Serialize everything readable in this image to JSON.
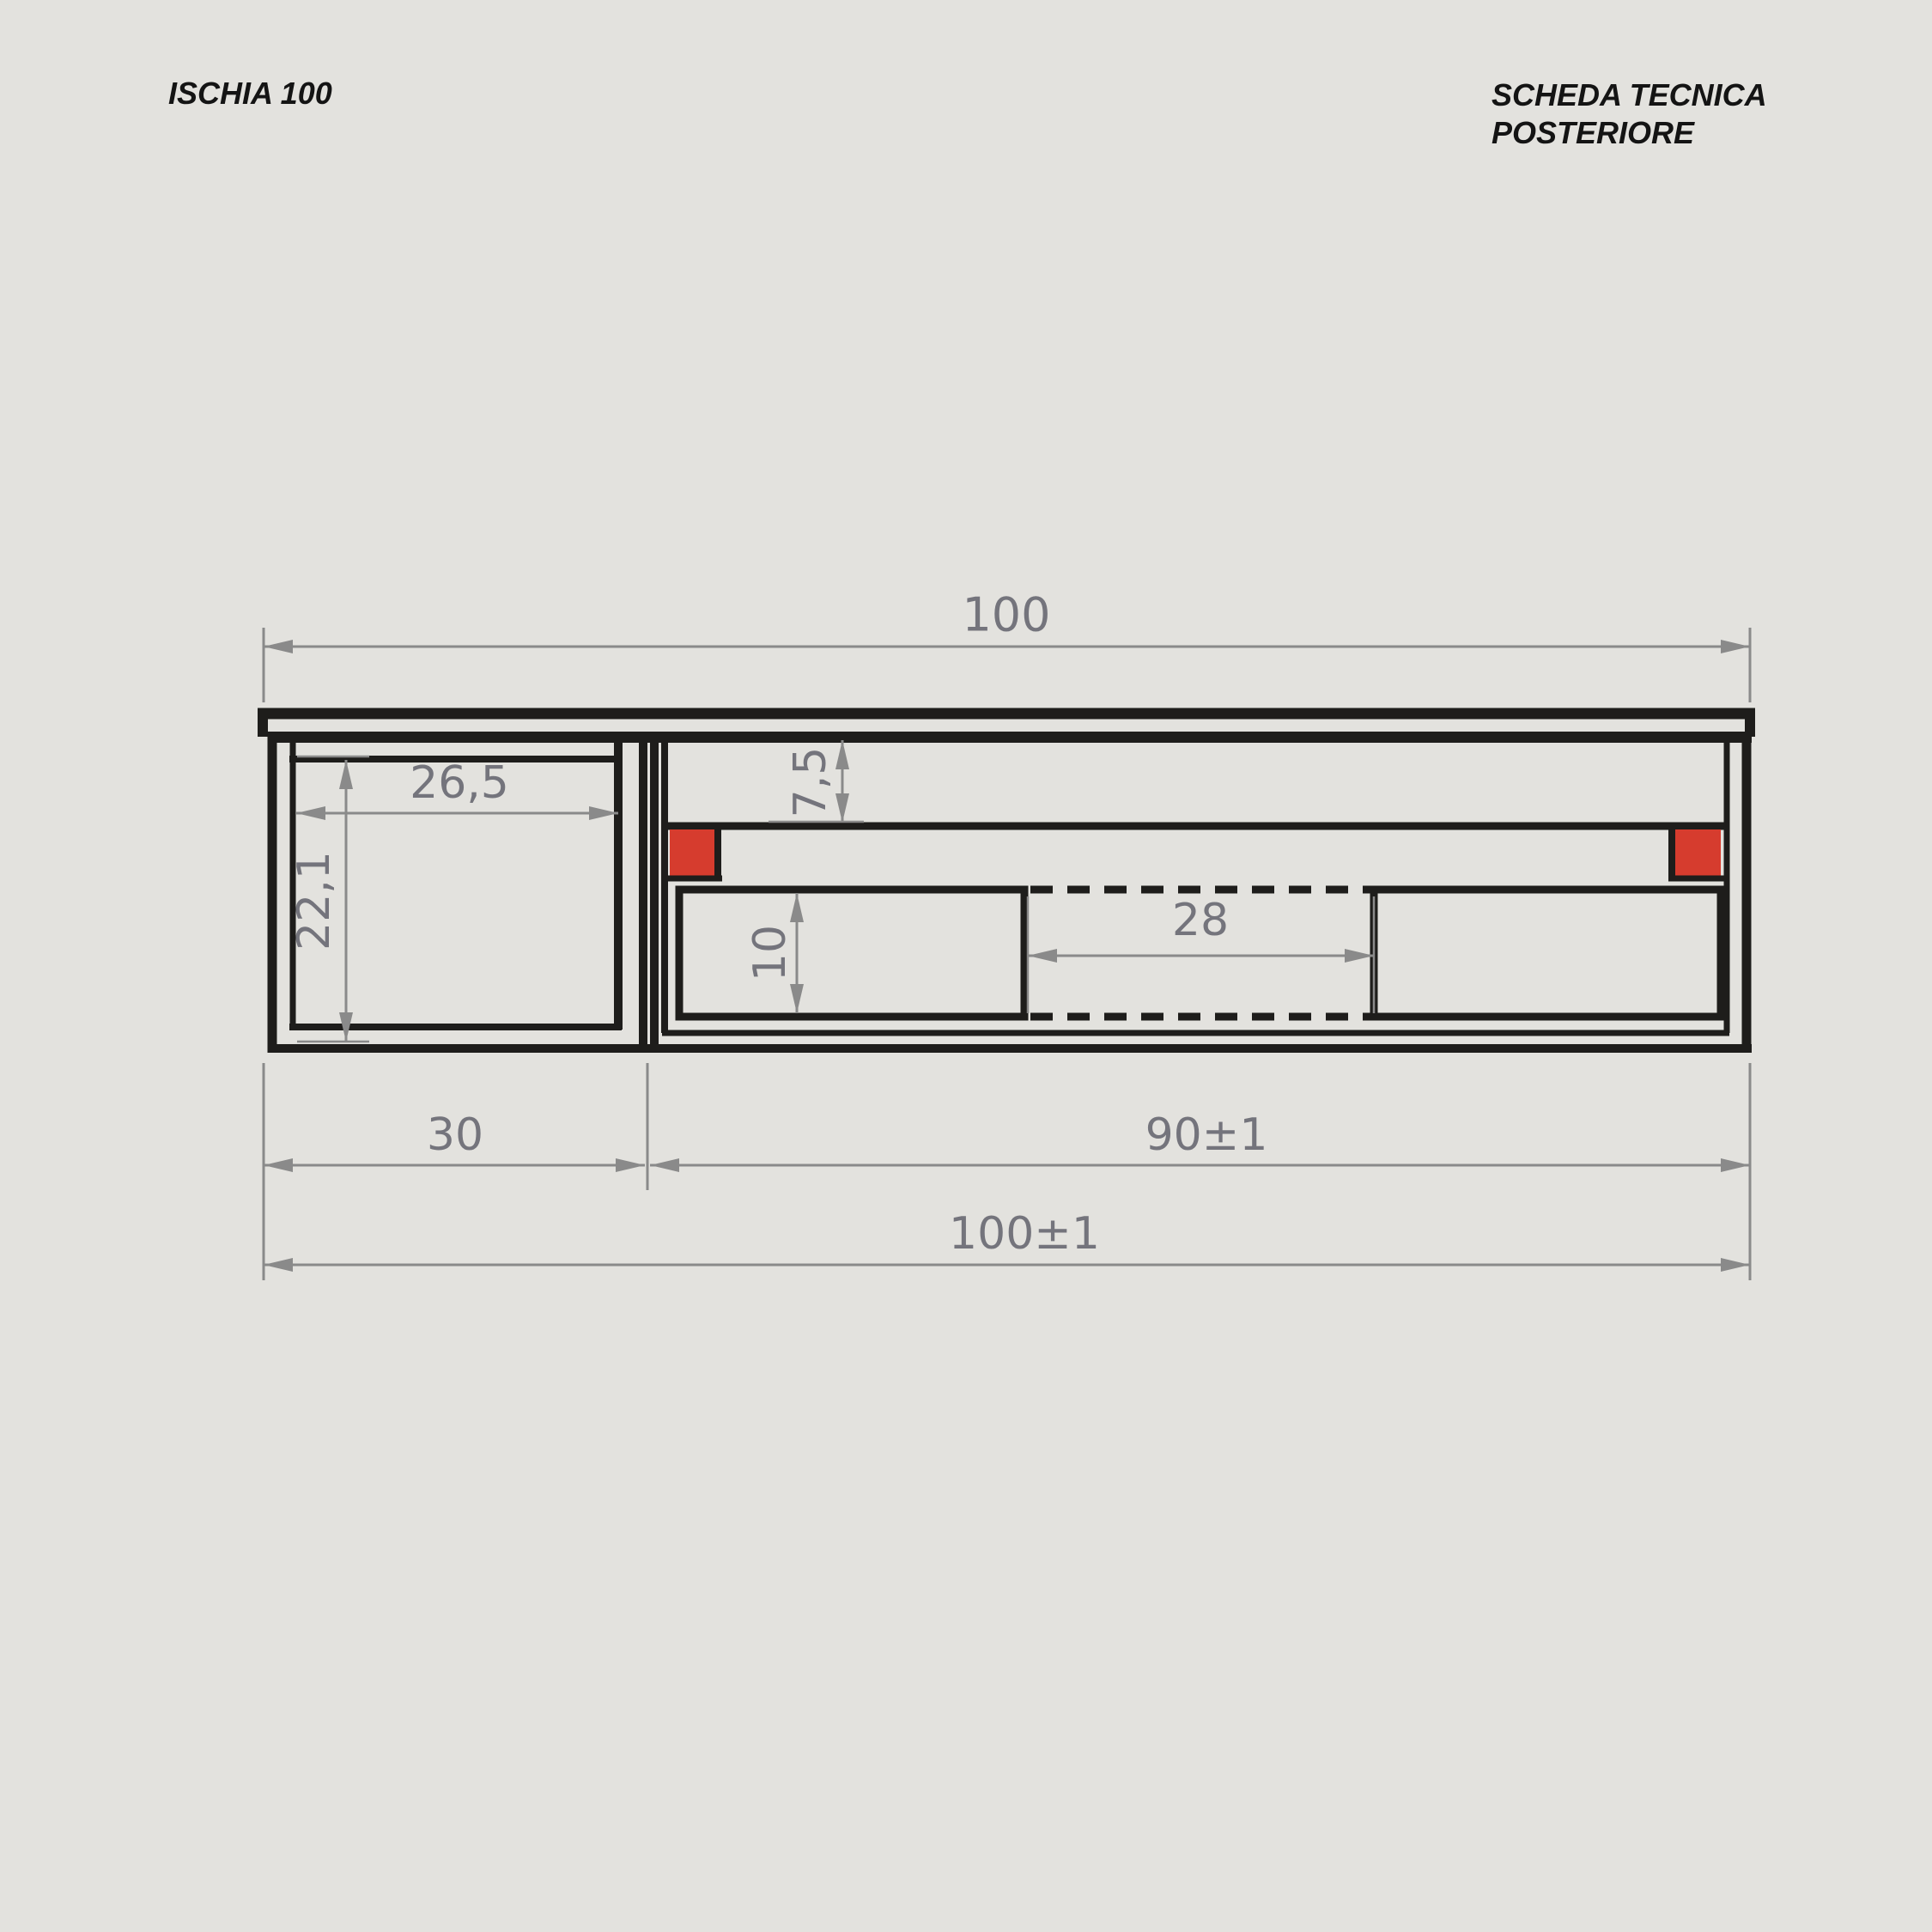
{
  "colors": {
    "background": "#e3e2de",
    "line": "#1e1d1b",
    "dimension_line": "#8a8a8a",
    "dimension_text": "#74747c",
    "accent_red": "#d63c2e",
    "title_text": "#141414"
  },
  "header": {
    "model": "ISCHIA 100",
    "sheet_title": "SCHEDA TECNICA",
    "sheet_subtitle": "POSTERIORE"
  },
  "drawing": {
    "type": "technical-drawing",
    "view": "rear",
    "dimensions": {
      "overall_width_top": "100",
      "left_compartment_width": "26,5",
      "left_compartment_height": "22,1",
      "rail_offset_from_top": "7,5",
      "drawer_opening_height": "10",
      "center_clearance_width": "28",
      "left_module_width": "30",
      "right_module_width": "90±1",
      "overall_width_bottom": "100±1"
    }
  }
}
